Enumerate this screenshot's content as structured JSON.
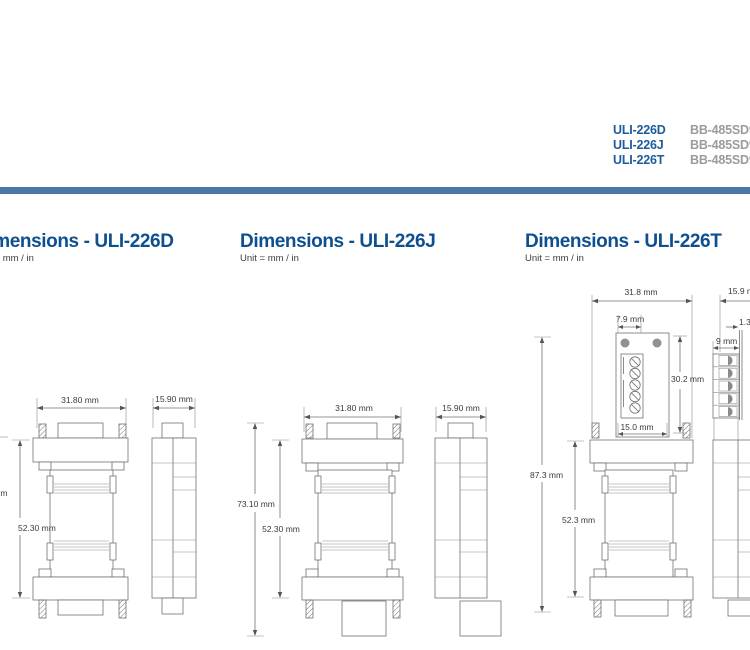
{
  "divider": {
    "color": "#4a78a6"
  },
  "product_table": {
    "rows": [
      {
        "model": "ULI-226D",
        "alt": "BB-485SD9"
      },
      {
        "model": "ULI-226J",
        "alt": "BB-485SD9"
      },
      {
        "model": "ULI-226T",
        "alt": "BB-485SD9"
      }
    ]
  },
  "sections": [
    {
      "title": "Dimensions - ULI-226D",
      "unit": "Unit = mm / in",
      "dims": {
        "front_width": "31.80 mm",
        "side_width": "15.90 mm",
        "body_height": "52.30 mm",
        "overall_height_fragment": "m"
      }
    },
    {
      "title": "Dimensions - ULI-226J",
      "unit": "Unit = mm / in",
      "dims": {
        "front_width": "31.80 mm",
        "side_width": "15.90 mm",
        "body_height": "52.30 mm",
        "overall_height": "73.10 mm"
      }
    },
    {
      "title": "Dimensions - ULI-226T",
      "unit": "Unit = mm / in",
      "dims": {
        "front_width": "31.8 mm",
        "side_width": "15.9 mm",
        "body_height": "52.3 mm",
        "overall_height": "87.3 mm",
        "tab_width": "7.9 mm",
        "terminal_height": "30.2 mm",
        "terminal_width": "15.0 mm",
        "side_depth": "9 mm",
        "plate_thickness": "1.3"
      }
    }
  ]
}
